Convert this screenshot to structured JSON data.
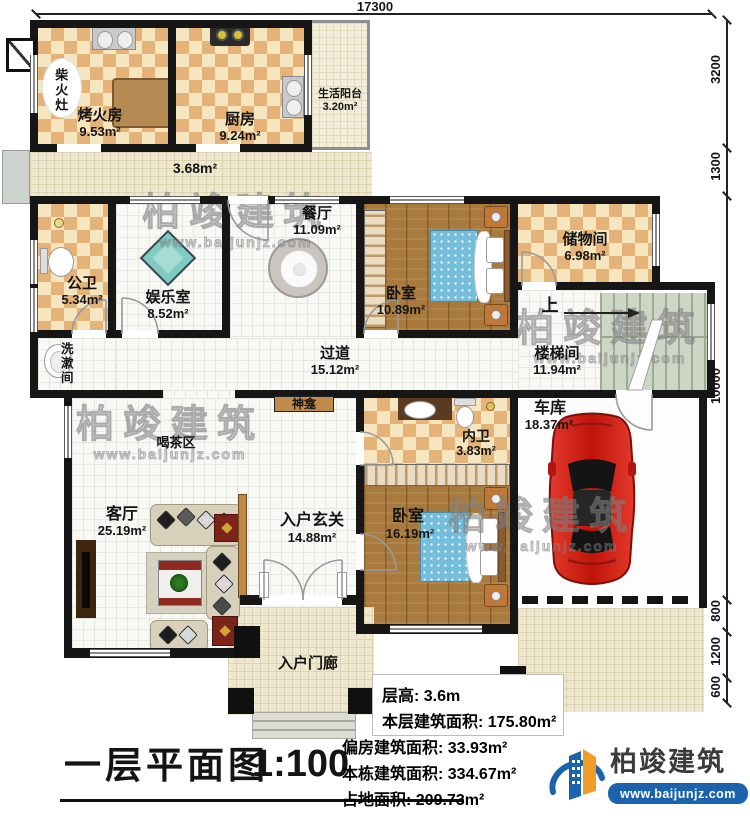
{
  "dims": {
    "top": "17300",
    "right": [
      "3200",
      "1300",
      "10000",
      "800",
      "1200",
      "600"
    ]
  },
  "rooms": {
    "chaihuozao": {
      "name": "柴火灶"
    },
    "kaohuofang": {
      "name": "烤火房",
      "area": "9.53m²"
    },
    "chufang": {
      "name": "厨房",
      "area": "9.24m²"
    },
    "shenghuoyangtai": {
      "name": "生活阳台",
      "area": "3.20m²"
    },
    "corridor": {
      "area": "3.68m²"
    },
    "gongwei": {
      "name": "公卫",
      "area": "5.34m²"
    },
    "yuleshi": {
      "name": "娱乐室",
      "area": "8.52m²"
    },
    "canting": {
      "name": "餐厅",
      "area": "11.09m²"
    },
    "xishujian": {
      "name": "洗漱间"
    },
    "woshi1": {
      "name": "卧室",
      "area": "10.89m²"
    },
    "chuwujian": {
      "name": "储物间",
      "area": "6.98m²"
    },
    "guodao": {
      "name": "过道",
      "area": "15.12m²"
    },
    "loutijian": {
      "name": "楼梯间",
      "area": "11.94m²",
      "up": "上"
    },
    "shenkan": {
      "name": "神龛"
    },
    "hechaqu": {
      "name": "喝茶区"
    },
    "keting": {
      "name": "客厅",
      "area": "25.19m²"
    },
    "xuanguan": {
      "name": "入户玄关",
      "area": "14.88m²"
    },
    "neiwei": {
      "name": "内卫",
      "area": "3.83m²"
    },
    "woshi2": {
      "name": "卧室",
      "area": "16.19m²"
    },
    "cheku": {
      "name": "车库",
      "area": "18.37m²"
    },
    "menlang": {
      "name": "入户门廊"
    }
  },
  "info": {
    "lines": [
      "层高: 3.6m",
      "本层建筑面积: 175.80m²",
      "偏房建筑面积: 33.93m²",
      "本栋建筑面积: 334.67m²",
      "占地面积: 209.73m²"
    ]
  },
  "title": {
    "name": "一层平面图",
    "scale": "1:100"
  },
  "logo": {
    "brand": "柏竣建筑",
    "site": "www.baijunjz.com"
  },
  "watermark": {
    "brand": "柏竣建筑",
    "site": "www.baijunjz.com"
  },
  "colors": {
    "wall": "#161616",
    "checker_dark": "#e5b277",
    "checker_light": "#f6e6c0",
    "wood": "#a87a3e",
    "stairs": "#ccd5c6",
    "bed": "#74bedc",
    "brand_blue": "#1b63ac",
    "brand_orange": "#f09c28",
    "car_red": "#c9201d"
  }
}
